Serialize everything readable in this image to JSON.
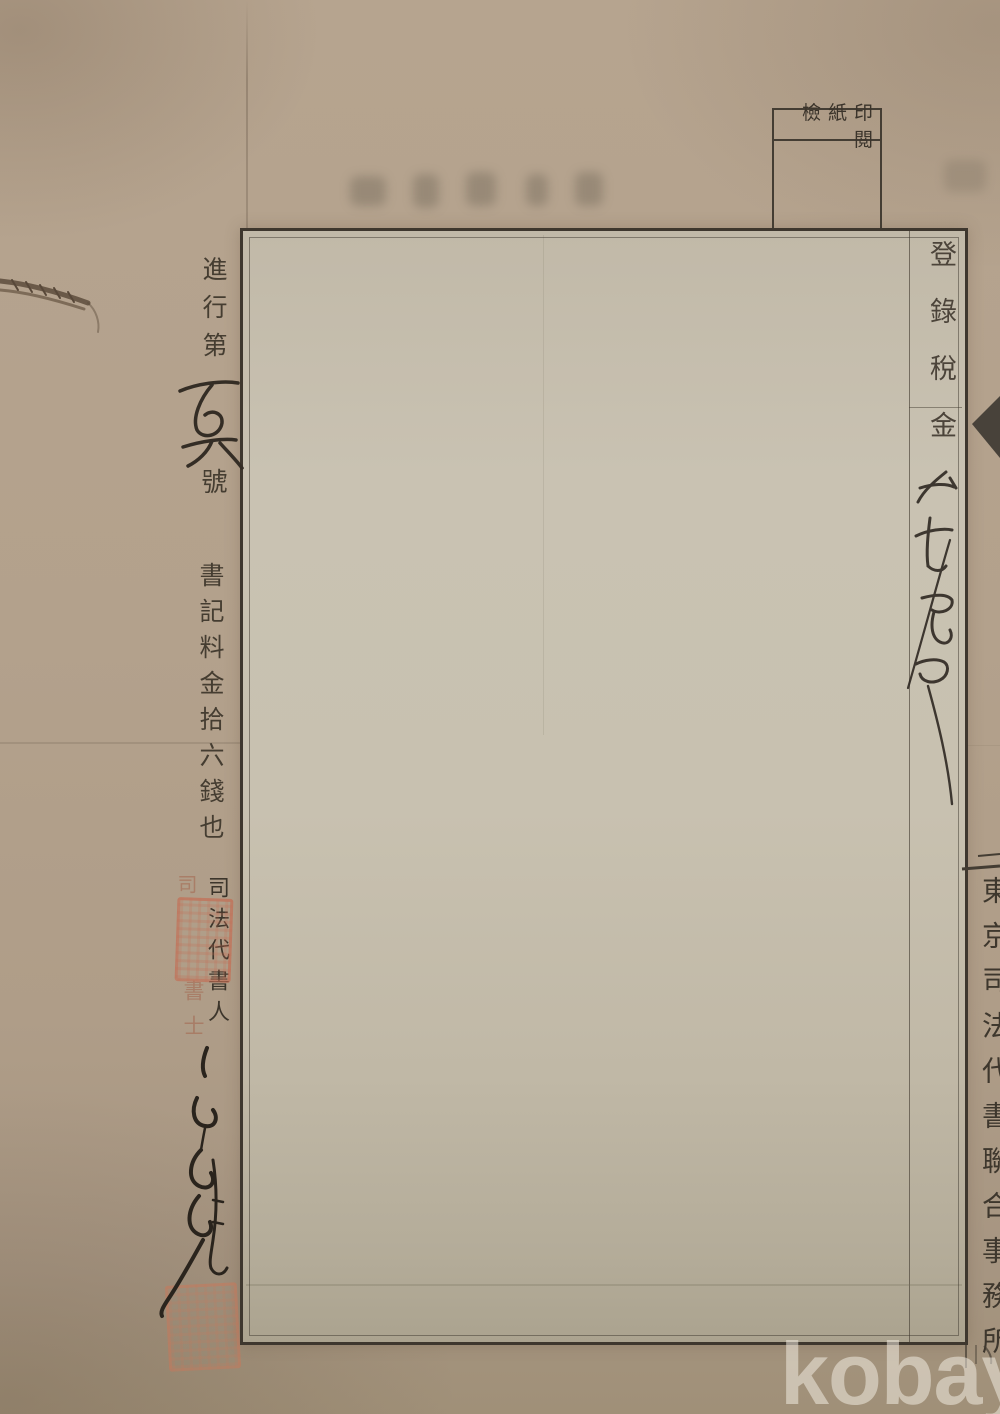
{
  "photo": {
    "description": "scanned vintage Japanese legal document page",
    "stamp_box": {
      "label": "印紙檢閲"
    },
    "tax_column": {
      "label": "登錄稅金",
      "handwritten_amount": "弐拾五也"
    },
    "left_margin": {
      "progress_prefix": "進行第",
      "progress_number_handwritten": "百六",
      "progress_suffix": "號",
      "clerk_fee_line": "書記料金拾六錢也",
      "scrivener_title": "司法代書人",
      "faint_stamp_top": "司",
      "faint_stamp_bottom": "書士"
    },
    "right_edge": {
      "partial_text": "東京司法代書聯合事務所"
    },
    "watermark": {
      "text": "kobay"
    },
    "colors": {
      "paper": "#b2a08c",
      "sheet": "#c6bfae",
      "ink": "#3b342b",
      "seal_red": "#c46c52",
      "watermark": "#f0ebe1"
    }
  }
}
